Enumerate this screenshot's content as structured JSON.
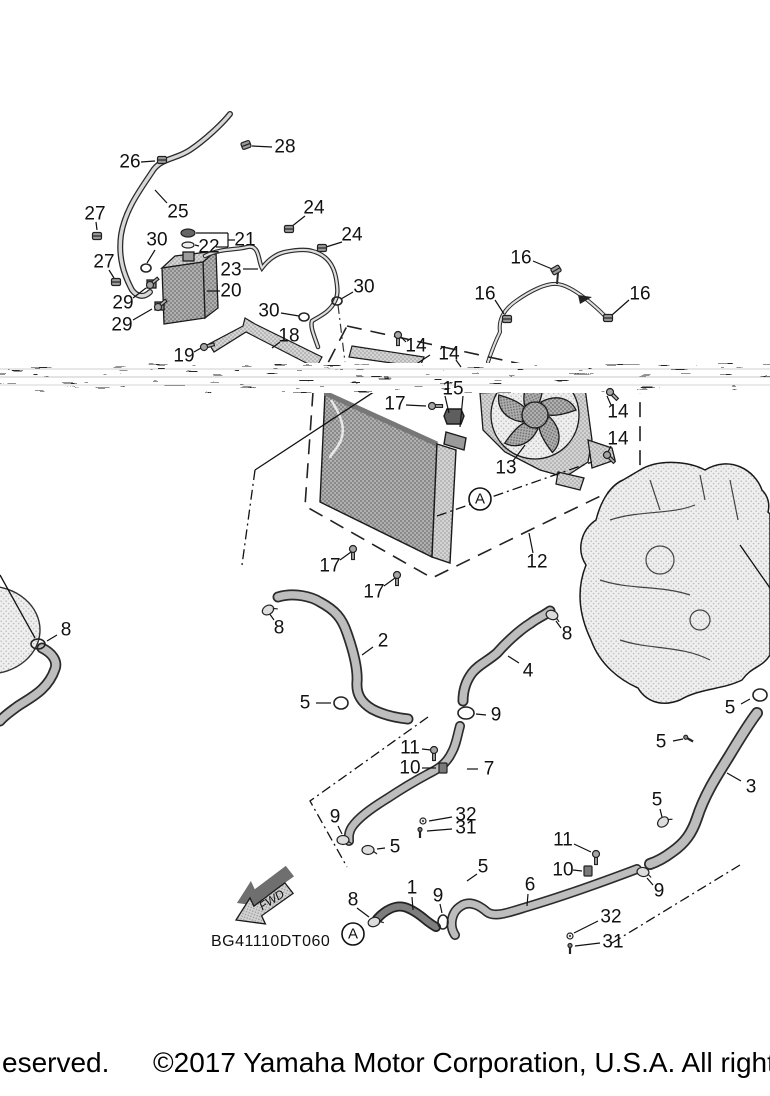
{
  "diagram": {
    "code": "BG41110DT060",
    "fwd_label": "FWD",
    "view_labels": [
      {
        "text": "A",
        "x": 480,
        "y": 499
      },
      {
        "text": "A",
        "x": 353,
        "y": 934
      }
    ],
    "callouts": [
      {
        "text": "28",
        "x": 285,
        "y": 147,
        "leader": [
          252,
          146,
          272,
          147
        ]
      },
      {
        "text": "26",
        "x": 130,
        "y": 162,
        "leader": [
          141,
          162,
          155,
          161
        ]
      },
      {
        "text": "25",
        "x": 178,
        "y": 212,
        "leader": [
          167,
          203,
          155,
          190
        ]
      },
      {
        "text": "27",
        "x": 95,
        "y": 214,
        "leader": [
          96,
          222,
          97,
          230
        ]
      },
      {
        "text": "27",
        "x": 104,
        "y": 262,
        "leader": [
          109,
          270,
          114,
          278
        ]
      },
      {
        "text": "30",
        "x": 157,
        "y": 240,
        "leader": [
          155,
          250,
          147,
          263
        ]
      },
      {
        "text": "22",
        "x": 209,
        "y": 247,
        "leader": [
          199,
          246,
          195,
          245
        ]
      },
      {
        "text": "21",
        "x": 245,
        "y": 240
      },
      {
        "text": "24",
        "x": 314,
        "y": 208,
        "leader": [
          305,
          216,
          291,
          227
        ]
      },
      {
        "text": "24",
        "x": 352,
        "y": 235,
        "leader": [
          342,
          242,
          326,
          247
        ]
      },
      {
        "text": "23",
        "x": 231,
        "y": 270,
        "leader": [
          243,
          269,
          258,
          269
        ]
      },
      {
        "text": "20",
        "x": 231,
        "y": 291,
        "leader": [
          220,
          291,
          207,
          291
        ]
      },
      {
        "text": "29",
        "x": 123,
        "y": 303,
        "leader": [
          133,
          298,
          146,
          288
        ]
      },
      {
        "text": "29",
        "x": 122,
        "y": 325,
        "leader": [
          133,
          320,
          152,
          309
        ]
      },
      {
        "text": "30",
        "x": 269,
        "y": 311,
        "leader": [
          281,
          313,
          299,
          316
        ]
      },
      {
        "text": "30",
        "x": 364,
        "y": 287,
        "leader": [
          353,
          292,
          341,
          299
        ]
      },
      {
        "text": "18",
        "x": 289,
        "y": 336,
        "leader": [
          280,
          342,
          272,
          348
        ]
      },
      {
        "text": "19",
        "x": 184,
        "y": 356,
        "leader": [
          194,
          352,
          201,
          348
        ]
      },
      {
        "text": "16",
        "x": 521,
        "y": 258,
        "leader": [
          533,
          261,
          552,
          269
        ]
      },
      {
        "text": "16",
        "x": 485,
        "y": 294,
        "leader": [
          495,
          300,
          504,
          314
        ]
      },
      {
        "text": "16",
        "x": 640,
        "y": 294,
        "leader": [
          629,
          300,
          612,
          315
        ]
      },
      {
        "text": "14",
        "x": 416,
        "y": 346,
        "leader": [
          406,
          342,
          401,
          337
        ]
      },
      {
        "text": "14",
        "x": 449,
        "y": 354,
        "leader": [
          456,
          360,
          461,
          367
        ]
      },
      {
        "text": "14",
        "x": 618,
        "y": 412,
        "leader": [
          611,
          405,
          607,
          396
        ]
      },
      {
        "text": "14",
        "x": 618,
        "y": 439,
        "leader": [
          611,
          446,
          608,
          452
        ]
      },
      {
        "text": "13",
        "x": 506,
        "y": 468,
        "leader": [
          513,
          461,
          525,
          445
        ]
      },
      {
        "text": "15",
        "x": 453,
        "y": 389
      },
      {
        "text": "17",
        "x": 395,
        "y": 404,
        "leader": [
          406,
          405,
          426,
          406
        ]
      },
      {
        "text": "17",
        "x": 330,
        "y": 566,
        "leader": [
          340,
          560,
          351,
          552
        ]
      },
      {
        "text": "17",
        "x": 374,
        "y": 592,
        "leader": [
          384,
          586,
          395,
          578
        ]
      },
      {
        "text": "12",
        "x": 537,
        "y": 562,
        "leader": [
          533,
          553,
          529,
          533
        ]
      },
      {
        "text": "8",
        "x": 66,
        "y": 630,
        "leader": [
          57,
          635,
          47,
          641
        ]
      },
      {
        "text": "8",
        "x": 279,
        "y": 628,
        "leader": [
          274,
          620,
          269,
          613
        ]
      },
      {
        "text": "2",
        "x": 383,
        "y": 641,
        "leader": [
          373,
          647,
          362,
          655
        ]
      },
      {
        "text": "5",
        "x": 305,
        "y": 703,
        "leader": [
          316,
          703,
          331,
          703
        ]
      },
      {
        "text": "8",
        "x": 567,
        "y": 634,
        "leader": [
          561,
          628,
          556,
          621
        ]
      },
      {
        "text": "4",
        "x": 528,
        "y": 671,
        "leader": [
          519,
          663,
          508,
          656
        ]
      },
      {
        "text": "9",
        "x": 496,
        "y": 715,
        "leader": [
          486,
          715,
          476,
          714
        ]
      },
      {
        "text": "5",
        "x": 730,
        "y": 708,
        "leader": [
          741,
          704,
          750,
          699
        ]
      },
      {
        "text": "5",
        "x": 661,
        "y": 742,
        "leader": [
          673,
          741,
          683,
          739
        ]
      },
      {
        "text": "3",
        "x": 751,
        "y": 787,
        "leader": [
          741,
          781,
          727,
          773
        ]
      },
      {
        "text": "5",
        "x": 657,
        "y": 800,
        "leader": [
          660,
          809,
          662,
          817
        ]
      },
      {
        "text": "11",
        "x": 410,
        "y": 748,
        "leader": [
          422,
          749,
          431,
          750
        ]
      },
      {
        "text": "10",
        "x": 410,
        "y": 768,
        "leader": [
          422,
          768,
          436,
          768
        ]
      },
      {
        "text": "7",
        "x": 489,
        "y": 769,
        "leader": [
          478,
          769,
          467,
          769
        ]
      },
      {
        "text": "32",
        "x": 466,
        "y": 815,
        "leader": [
          452,
          817,
          429,
          821
        ]
      },
      {
        "text": "31",
        "x": 466,
        "y": 828,
        "leader": [
          452,
          829,
          427,
          831
        ]
      },
      {
        "text": "9",
        "x": 335,
        "y": 817,
        "leader": [
          338,
          826,
          342,
          834
        ]
      },
      {
        "text": "5",
        "x": 395,
        "y": 847,
        "leader": [
          385,
          848,
          377,
          849
        ]
      },
      {
        "text": "11",
        "x": 563,
        "y": 840,
        "leader": [
          574,
          844,
          591,
          852
        ]
      },
      {
        "text": "10",
        "x": 563,
        "y": 870,
        "leader": [
          573,
          870,
          582,
          871
        ]
      },
      {
        "text": "6",
        "x": 530,
        "y": 885,
        "leader": [
          528,
          894,
          527,
          906
        ]
      },
      {
        "text": "9",
        "x": 659,
        "y": 891,
        "leader": [
          653,
          885,
          647,
          878
        ]
      },
      {
        "text": "32",
        "x": 611,
        "y": 917,
        "leader": [
          598,
          921,
          574,
          933
        ]
      },
      {
        "text": "31",
        "x": 613,
        "y": 942,
        "leader": [
          600,
          943,
          575,
          946
        ]
      },
      {
        "text": "1",
        "x": 412,
        "y": 888,
        "leader": [
          412,
          897,
          413,
          910
        ]
      },
      {
        "text": "8",
        "x": 353,
        "y": 900,
        "leader": [
          357,
          908,
          369,
          917
        ]
      },
      {
        "text": "9",
        "x": 438,
        "y": 896,
        "leader": [
          440,
          904,
          442,
          913
        ]
      },
      {
        "text": "5",
        "x": 483,
        "y": 867,
        "leader": [
          477,
          874,
          467,
          881
        ]
      }
    ],
    "fasteners": [
      {
        "type": "nut",
        "x": 246,
        "y": 145,
        "rot": -20
      },
      {
        "type": "nut",
        "x": 162,
        "y": 160,
        "rot": 0
      },
      {
        "type": "nut",
        "x": 97,
        "y": 236,
        "rot": 0
      },
      {
        "type": "nut",
        "x": 116,
        "y": 282,
        "rot": 0
      },
      {
        "type": "nut",
        "x": 289,
        "y": 229,
        "rot": 0
      },
      {
        "type": "nut",
        "x": 322,
        "y": 248,
        "rot": 0
      },
      {
        "type": "nut",
        "x": 556,
        "y": 270,
        "rot": -30
      },
      {
        "type": "nut",
        "x": 507,
        "y": 319,
        "rot": 0
      },
      {
        "type": "nut",
        "x": 608,
        "y": 318,
        "rot": 0
      },
      {
        "type": "cap",
        "x": 188,
        "y": 233
      },
      {
        "type": "capring",
        "x": 188,
        "y": 245
      },
      {
        "type": "ring",
        "x": 146,
        "y": 268,
        "rx": 5,
        "ry": 4
      },
      {
        "type": "ring",
        "x": 304,
        "y": 317,
        "rx": 5,
        "ry": 4
      },
      {
        "type": "ring",
        "x": 337,
        "y": 301,
        "rx": 5,
        "ry": 4
      },
      {
        "type": "ring",
        "x": 466,
        "y": 713,
        "rx": 8,
        "ry": 6
      },
      {
        "type": "ring",
        "x": 443,
        "y": 922,
        "rx": 5,
        "ry": 7
      },
      {
        "type": "ring",
        "x": 341,
        "y": 703,
        "rx": 7,
        "ry": 6
      },
      {
        "type": "ring",
        "x": 760,
        "y": 695,
        "rx": 7,
        "ry": 6
      },
      {
        "type": "ring",
        "x": 38,
        "y": 644,
        "rx": 7,
        "ry": 5
      },
      {
        "type": "bolt",
        "x": 150,
        "y": 285,
        "rot": -40
      },
      {
        "type": "bolt",
        "x": 158,
        "y": 307,
        "rot": -40
      },
      {
        "type": "bolt",
        "x": 204,
        "y": 347,
        "rot": -15
      },
      {
        "type": "bolt",
        "x": 398,
        "y": 335,
        "rot": 90
      },
      {
        "type": "bolt",
        "x": 432,
        "y": 406,
        "rot": 0
      },
      {
        "type": "bolt",
        "x": 353,
        "y": 549,
        "rot": 90
      },
      {
        "type": "bolt",
        "x": 397,
        "y": 575,
        "rot": 90
      },
      {
        "type": "bolt",
        "x": 610,
        "y": 392,
        "rot": 45
      },
      {
        "type": "bolt",
        "x": 607,
        "y": 455,
        "rot": 45
      },
      {
        "type": "bolt",
        "x": 434,
        "y": 750,
        "rot": 90
      },
      {
        "type": "bolt",
        "x": 596,
        "y": 854,
        "rot": 90
      },
      {
        "type": "screw",
        "x": 687,
        "y": 738,
        "rot": 30
      },
      {
        "type": "screw",
        "x": 420,
        "y": 831,
        "rot": 90
      },
      {
        "type": "screw",
        "x": 570,
        "y": 947,
        "rot": 90
      },
      {
        "type": "washer",
        "x": 423,
        "y": 821
      },
      {
        "type": "washer",
        "x": 570,
        "y": 936
      },
      {
        "type": "clamp",
        "x": 268,
        "y": 610,
        "rot": -30
      },
      {
        "type": "clamp",
        "x": 552,
        "y": 615,
        "rot": 20
      },
      {
        "type": "clamp",
        "x": 374,
        "y": 922,
        "rot": -20
      },
      {
        "type": "clamp",
        "x": 343,
        "y": 840,
        "rot": 0
      },
      {
        "type": "clamp",
        "x": 368,
        "y": 850,
        "rot": 0
      },
      {
        "type": "clamp",
        "x": 663,
        "y": 822,
        "rot": -40
      },
      {
        "type": "clamp",
        "x": 643,
        "y": 872,
        "rot": 10
      },
      {
        "type": "bracket",
        "x": 443,
        "y": 768
      },
      {
        "type": "bracket",
        "x": 588,
        "y": 871
      }
    ]
  },
  "footer": {
    "copyright_fragment_left": "eserved.",
    "copyright_main": "©2017 Yamaha Motor Corporation, U.S.A. All rights reserved."
  },
  "colors": {
    "line": "#1a1a1a",
    "hose_inner": "#c9c9c9",
    "part_gray": "#a9a9a9",
    "background": "#ffffff"
  }
}
